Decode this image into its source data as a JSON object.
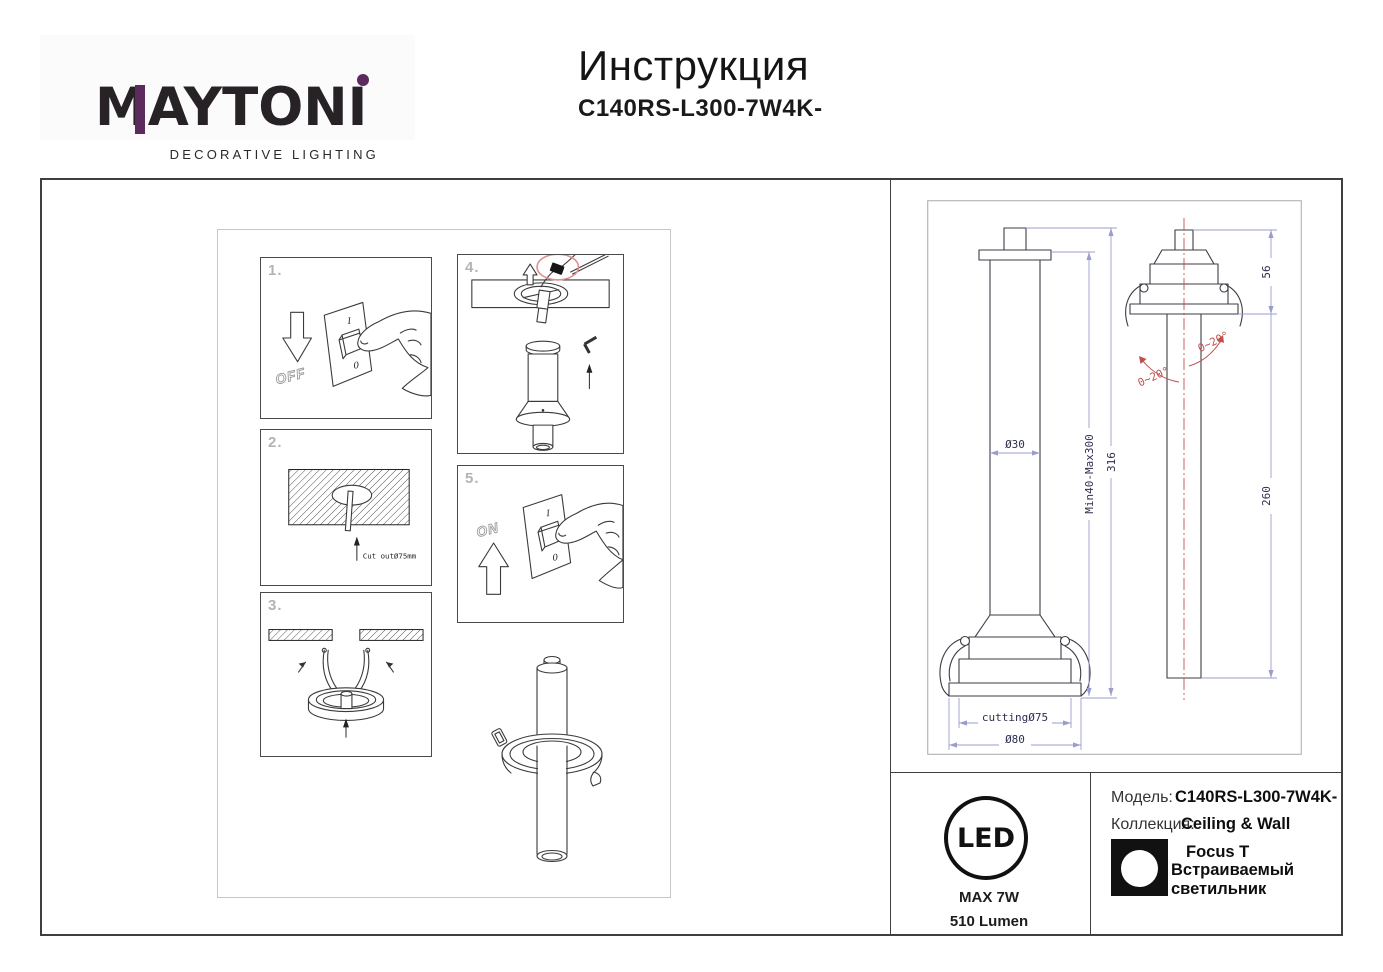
{
  "header": {
    "brand": "MAYTONI",
    "tagline": "DECORATIVE LIGHTING",
    "title": "Инструкция",
    "model": "C140RS-L300-7W4K-"
  },
  "steps": {
    "s1": {
      "num": "1.",
      "on_mark": "I",
      "off_mark": "0",
      "arrow_label": "OFF"
    },
    "s2": {
      "num": "2.",
      "note": "Cut outØ75mm"
    },
    "s3": {
      "num": "3."
    },
    "s4": {
      "num": "4."
    },
    "s5": {
      "num": "5.",
      "on_mark": "I",
      "off_mark": "0",
      "arrow_label": "ON"
    }
  },
  "tech": {
    "dims": {
      "tube_diameter": "Ø30",
      "adjustable_length": "Min40-Max300",
      "total_height": "316",
      "cutting_hole": "cuttingØ75",
      "trim_diameter": "Ø80",
      "head_height": "56",
      "body_length": "260",
      "tilt_left": "0~20°",
      "tilt_right": "0~20°"
    }
  },
  "spec": {
    "led_label": "LED",
    "max_power": "MAX 7W",
    "luminous_flux": "510 Lumen",
    "model_label": "Модель:",
    "model_value": "C140RS-L300-7W4K-",
    "collection_label": "Коллекция:",
    "collection_value": "Ceiling & Wall",
    "series": "Focus T",
    "product_type": "Встраиваемый светильник"
  }
}
